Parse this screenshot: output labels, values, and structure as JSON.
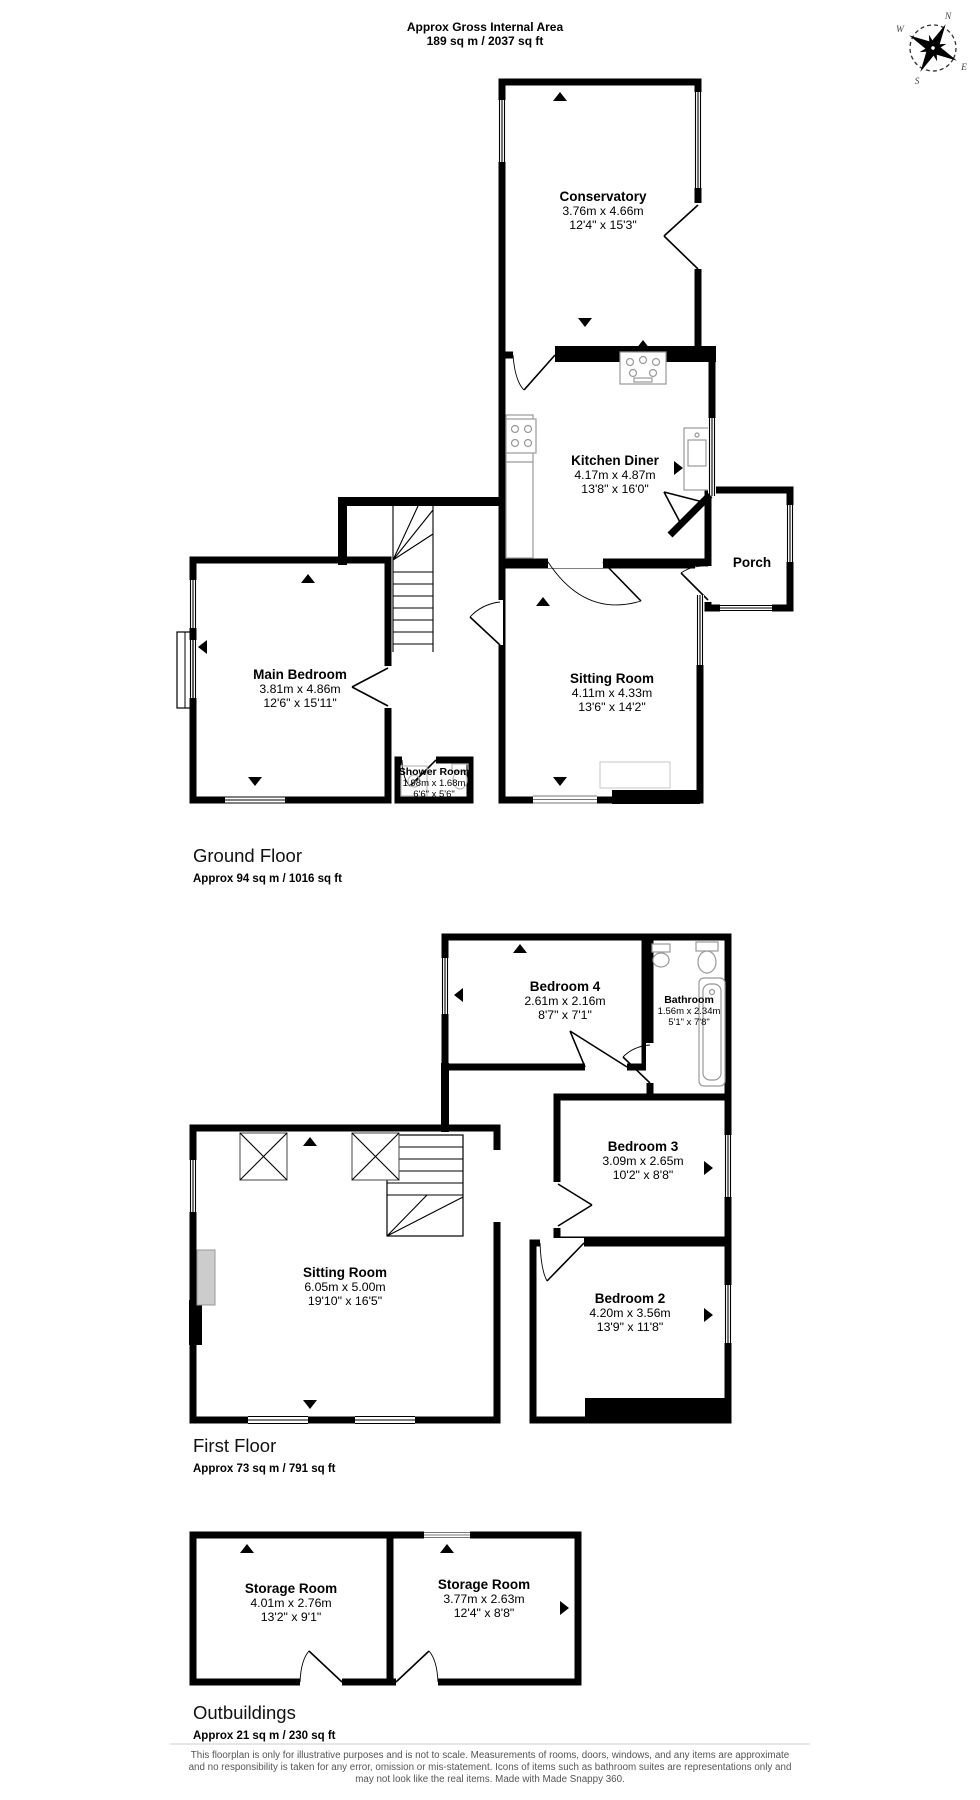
{
  "header": {
    "title": "Approx Gross Internal Area",
    "subtitle": "189 sq m / 2037 sq ft"
  },
  "compass": {
    "n": "N",
    "e": "E",
    "s": "S",
    "w": "W"
  },
  "rooms": {
    "conservatory": {
      "name": "Conservatory",
      "metric": "3.76m x 4.66m",
      "imperial": "12'4\" x 15'3\""
    },
    "kitchen_diner": {
      "name": "Kitchen Diner",
      "metric": "4.17m x 4.87m",
      "imperial": "13'8\" x 16'0\""
    },
    "porch": {
      "name": "Porch"
    },
    "sitting_room_ground": {
      "name": "Sitting Room",
      "metric": "4.11m x 4.33m",
      "imperial": "13'6\" x 14'2\""
    },
    "main_bedroom": {
      "name": "Main Bedroom",
      "metric": "3.81m x 4.86m",
      "imperial": "12'6\" x 15'11\""
    },
    "shower_room": {
      "name": "Shower Room",
      "metric": "1.98m x 1.68m",
      "imperial": "6'6\" x 5'6\""
    },
    "bedroom_4": {
      "name": "Bedroom 4",
      "metric": "2.61m x 2.16m",
      "imperial": "8'7\" x 7'1\""
    },
    "bathroom": {
      "name": "Bathroom",
      "metric": "1.56m x 2.34m",
      "imperial": "5'1\" x 7'8\""
    },
    "bedroom_3": {
      "name": "Bedroom 3",
      "metric": "3.09m x 2.65m",
      "imperial": "10'2\" x 8'8\""
    },
    "bedroom_2": {
      "name": "Bedroom 2",
      "metric": "4.20m x 3.56m",
      "imperial": "13'9\" x 11'8\""
    },
    "sitting_room_first": {
      "name": "Sitting Room",
      "metric": "6.05m x 5.00m",
      "imperial": "19'10\" x 16'5\""
    },
    "storage_room_1": {
      "name": "Storage Room",
      "metric": "4.01m x 2.76m",
      "imperial": "13'2\" x 9'1\""
    },
    "storage_room_2": {
      "name": "Storage Room",
      "metric": "3.77m x 2.63m",
      "imperial": "12'4\" x 8'8\""
    }
  },
  "floors": {
    "ground": {
      "label": "Ground Floor",
      "area": "Approx 94 sq m / 1016 sq ft"
    },
    "first": {
      "label": "First Floor",
      "area": "Approx 73 sq m / 791 sq ft"
    },
    "outbuildings": {
      "label": "Outbuildings",
      "area": "Approx 21 sq m / 230 sq ft"
    }
  },
  "disclaimer": {
    "line1": "This floorplan is only for illustrative purposes and is not to scale. Measurements of rooms, doors, windows, and any items are approximate",
    "line2": "and no responsibility is taken for any error, omission or mis-statement. Icons of items such as bathroom suites are representations only and",
    "line3": "may not look like the real items. Made with Made Snappy 360."
  },
  "colors": {
    "wall": "#000000",
    "background": "#ffffff",
    "fixture": "#999999",
    "disclaimer_text": "#555555"
  }
}
